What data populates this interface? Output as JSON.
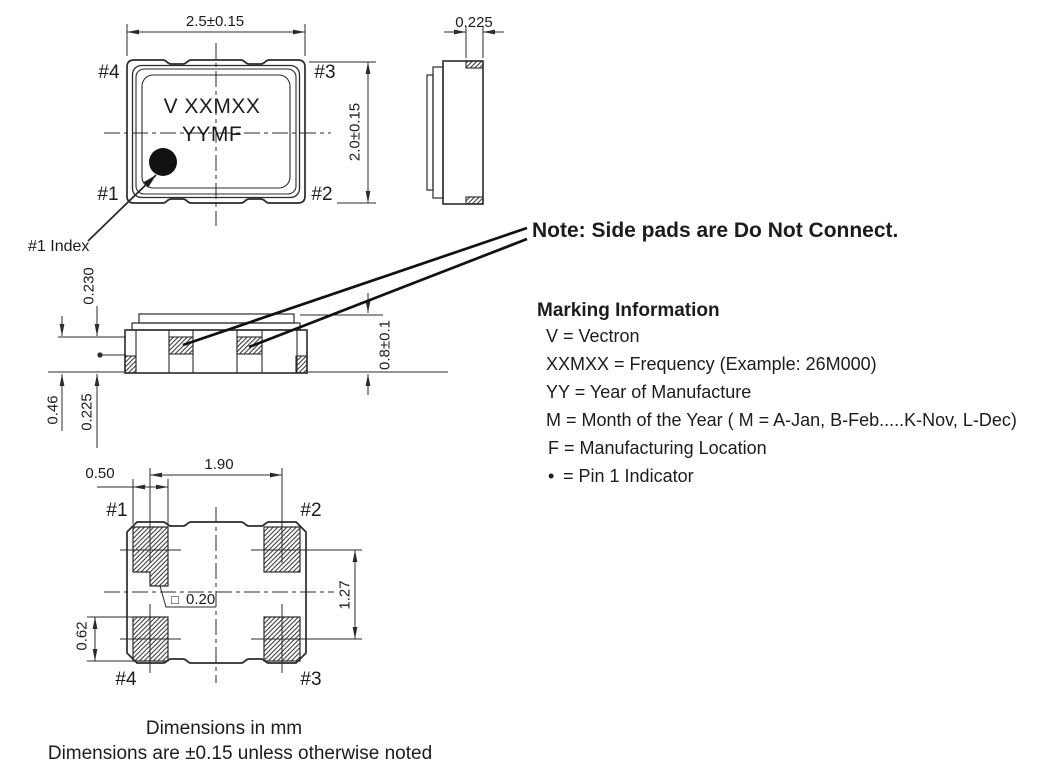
{
  "drawing": {
    "top_view": {
      "dim_width": "2.5±0.15",
      "dim_height": "2.0±0.15",
      "pins": {
        "p1": "#1",
        "p2": "#2",
        "p3": "#3",
        "p4": "#4"
      },
      "marking_line1": "V XXMXX",
      "marking_line2": "YYMF",
      "index_label": "#1 Index"
    },
    "end_view": {
      "dim_pad": "0.225"
    },
    "side_view": {
      "dim_lid": "0.230",
      "dim_side_pad": "0.46",
      "dim_terminal": "0.225",
      "dim_body_height": "0.8±0.1"
    },
    "bottom_view": {
      "dim_pad_pitch_x": "1.90",
      "dim_pad_width": "0.50",
      "dim_pad_pitch_y": "1.27",
      "dim_pad_height": "0.62",
      "index_notch_symbol": "□",
      "dim_index_notch": "0.20",
      "pins": {
        "p1": "#1",
        "p2": "#2",
        "p3": "#3",
        "p4": "#4"
      }
    }
  },
  "note": "Note: Side pads are Do Not Connect.",
  "marking_info": {
    "heading": "Marking Information",
    "lines": [
      "V = Vectron",
      "XXMXX = Frequency (Example: 26M000)",
      "YY = Year of Manufacture",
      "M = Month of the Year ( M = A-Jan, B-Feb.....K-Nov, L-Dec)",
      "F = Manufacturing Location"
    ],
    "pin1_symbol": "•",
    "pin1_text": "=  Pin 1 Indicator"
  },
  "footer": {
    "line1": "Dimensions in mm",
    "line2": "Dimensions are ±0.15 unless otherwise noted"
  },
  "colors": {
    "line": "#2b2b2b",
    "text": "#1c1c1c",
    "pin1_bullet": "#4a1a1a",
    "background": "#ffffff"
  }
}
